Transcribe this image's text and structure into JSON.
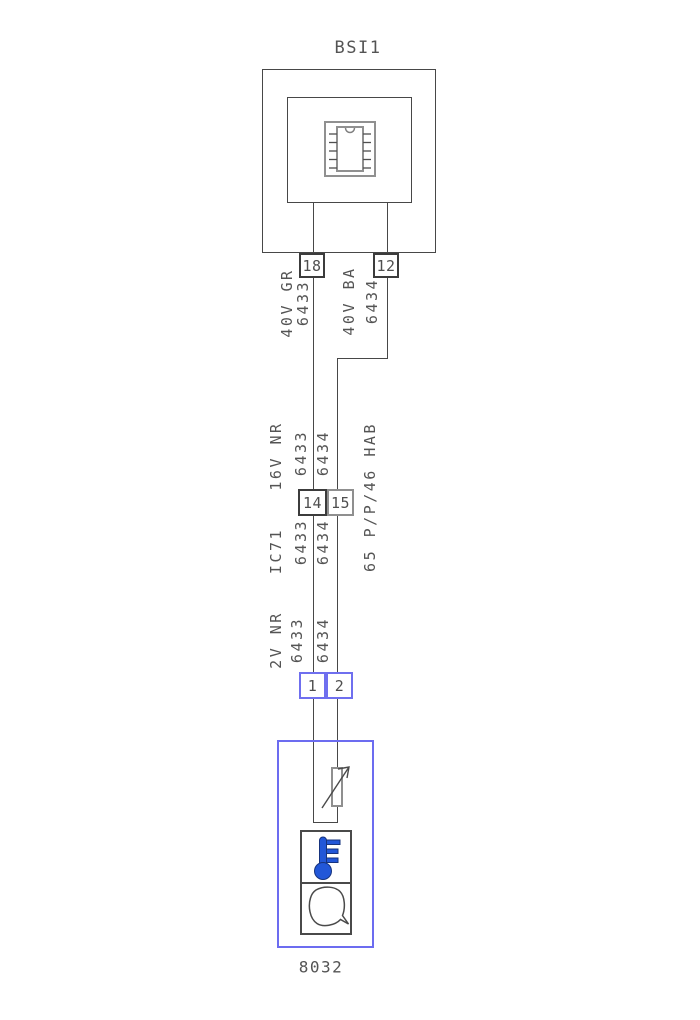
{
  "title": "BSI1",
  "component_label": "8032",
  "top_pins": {
    "left": "18",
    "right": "12"
  },
  "top_wires": {
    "left_name": "40V GR",
    "left_num": "6433",
    "right_name": "40V BA",
    "right_num": "6434"
  },
  "mid_connector": {
    "left_pin": "14",
    "right_pin": "15",
    "above_name": "16V NR",
    "above_left_num": "6433",
    "above_right_num": "6434",
    "below_name": "IC71",
    "below_left_num": "6433",
    "below_right_num": "6434",
    "side_label": "65 P/P/46 HAB"
  },
  "bottom_connector": {
    "left_pin": "1",
    "right_pin": "2",
    "above_name": "2V NR",
    "above_left_num": "6433",
    "above_right_num": "6434"
  },
  "icons": {
    "bsi_chip": "ic-chip-icon",
    "thermistor": "variable-resistor-icon",
    "thermometer": "thermometer-icon",
    "sensor_body": "sensor-housing-icon"
  },
  "colors": {
    "line": "#474747",
    "text": "#545454",
    "gray_border": "#8f8f8f",
    "connector_blue": "#6f6fef",
    "component_blue": "#6c6cf0",
    "thermometer_blue": "#2257d8"
  }
}
